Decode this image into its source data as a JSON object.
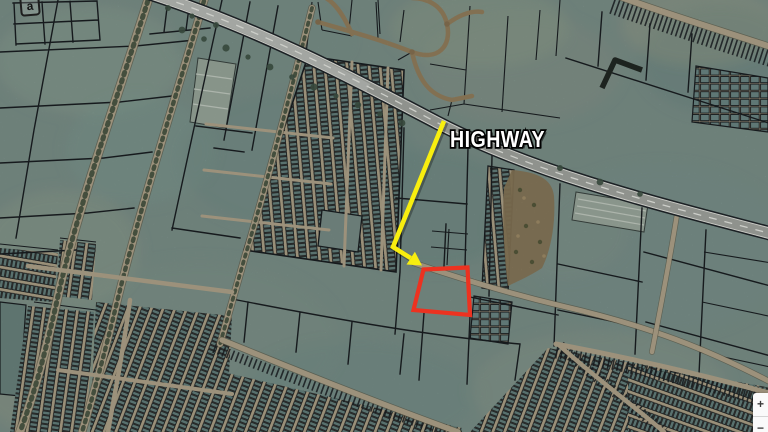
{
  "map": {
    "title": "Aerial cadastral map with marked parcel",
    "highway_label": "HIGHWAY",
    "watermark_letter": "a",
    "colors": {
      "annotation-yellow": "#f8ee0f",
      "annotation-red": "#ec3220",
      "parcel-line": "#1a1e22",
      "terrain-base": "#7e938c",
      "road-tan": "#b4a88e",
      "highway-asphalt": "#a6a9a3",
      "highway-marking": "#eceee8",
      "tree-green": "#3f5345",
      "orchard-brown": "#8a795a",
      "housing-cell": "#67837f"
    }
  },
  "controls": {
    "zoom_in": "+",
    "zoom_out": "−"
  }
}
